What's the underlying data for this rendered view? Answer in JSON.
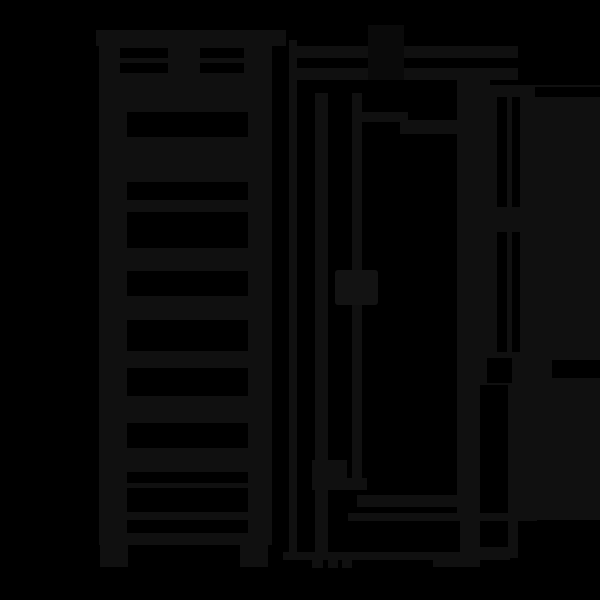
{
  "description": "Very dark monochrome technical drawing: tall ladder-style unit (rung front view, left) and side elevation with wall-mount lines (right) on a black background. No visible text or dimensions.",
  "colors": {
    "background": "#000000",
    "panel": "#101010",
    "panel_dark": "#0a0a0a",
    "panel_light": "#131313"
  }
}
